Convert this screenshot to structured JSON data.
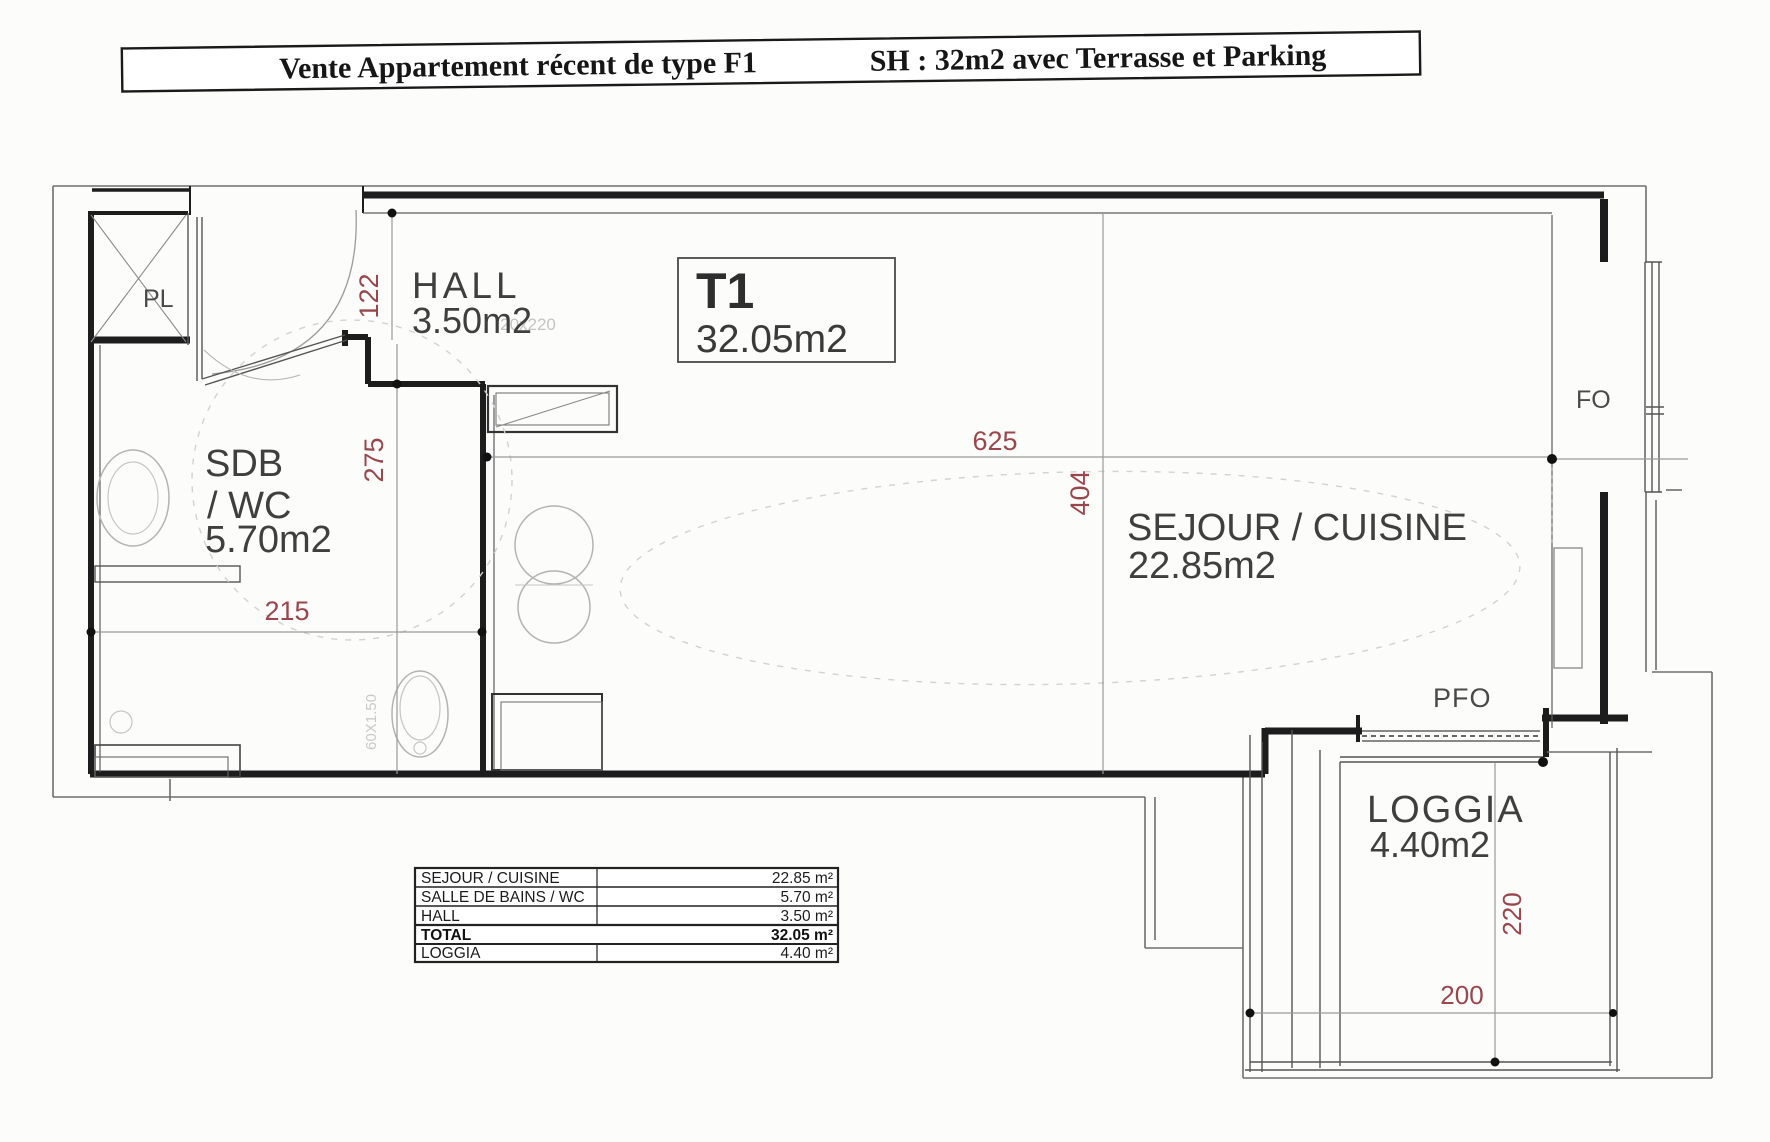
{
  "title": {
    "part1": "Vente Appartement récent de type F1",
    "part2": "SH : 32m2 avec Terrasse et Parking"
  },
  "unit": {
    "type": "T1",
    "area": "32.05m2"
  },
  "rooms": {
    "hall": {
      "name": "HALL",
      "area": "3.50m2"
    },
    "bathroom": {
      "line1": "SDB",
      "line2": "/ WC",
      "area": "5.70m2"
    },
    "living": {
      "name": "SEJOUR / CUISINE",
      "area": "22.85m2"
    },
    "loggia": {
      "name": "LOGGIA",
      "area": "4.40m2"
    }
  },
  "plan_labels": {
    "closet": "PL",
    "window": "FO",
    "patio_door": "PFO",
    "cupboard_dim": "20x220",
    "wc_dim": "60X1.50"
  },
  "dimensions": {
    "hall_depth": "122",
    "bath_depth": "275",
    "bath_width": "215",
    "living_width": "625",
    "living_depth": "404",
    "loggia_depth": "220",
    "loggia_width": "200"
  },
  "areas_table": {
    "rows": [
      {
        "label": "SEJOUR / CUISINE",
        "value": "22.85 m²"
      },
      {
        "label": "SALLE DE BAINS / WC",
        "value": "5.70 m²"
      },
      {
        "label": "HALL",
        "value": "3.50 m²"
      },
      {
        "label": "TOTAL",
        "value": "32.05 m²"
      },
      {
        "label": "LOGGIA",
        "value": "4.40 m²"
      }
    ]
  },
  "colors": {
    "dimension_red": "#9a464d",
    "wall": "#1d1d1d",
    "paper": "#fcfcfb"
  }
}
